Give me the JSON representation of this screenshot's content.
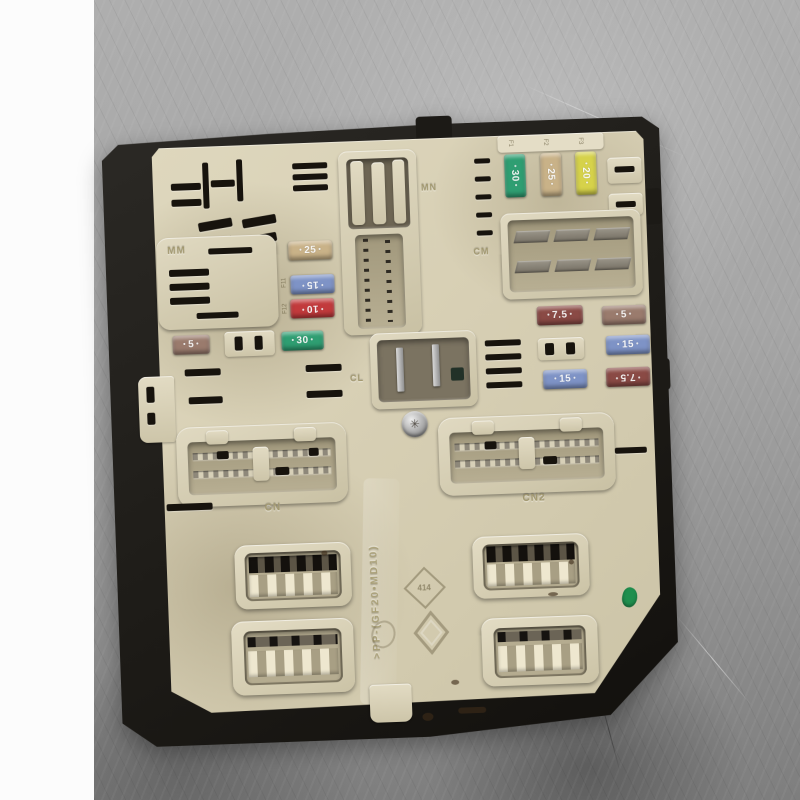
{
  "labels": {
    "mm": "MM",
    "mn": "MN",
    "cm": "CM",
    "cl": "CL",
    "cn": "CN",
    "cn2": "CN2",
    "fuse_refs_top": [
      "F1",
      "F2",
      "F3"
    ],
    "fuse_refs_column": [
      "F11",
      "F12"
    ],
    "molding_code": ">PP-(GF20•MD10)",
    "mold_mark": "414"
  },
  "fuses": {
    "top_row": [
      {
        "amps": "30",
        "color_key": "green"
      },
      {
        "amps": "25",
        "color_key": "tan"
      },
      {
        "amps": "20",
        "color_key": "yellow"
      }
    ],
    "center_column": [
      {
        "amps": "25",
        "color_key": "tan"
      },
      {
        "amps": "15",
        "color_key": "blue"
      },
      {
        "amps": "10",
        "color_key": "red"
      },
      {
        "amps": "30",
        "color_key": "green"
      }
    ],
    "left_single": {
      "amps": "5",
      "color_key": "brown"
    },
    "right_grid_rows": [
      [
        "7.5",
        "5"
      ],
      [
        "",
        "15"
      ],
      [
        "15",
        "7.5"
      ]
    ]
  },
  "colors": {
    "green": "#2f9e72",
    "tan": "#c9b288",
    "yellow": "#d6d24a",
    "blue": "#7e93c6",
    "red": "#c23a3c",
    "maroon": "#8a4a45",
    "brown": "#9a7b6d",
    "panel_beige": "#d7cfb4",
    "frame_black": "#1d1b17",
    "metal_grey": "#a2a2a2",
    "paint_dab_green": "#1f8f4e"
  },
  "icons": {
    "torx_screw": "✳"
  }
}
